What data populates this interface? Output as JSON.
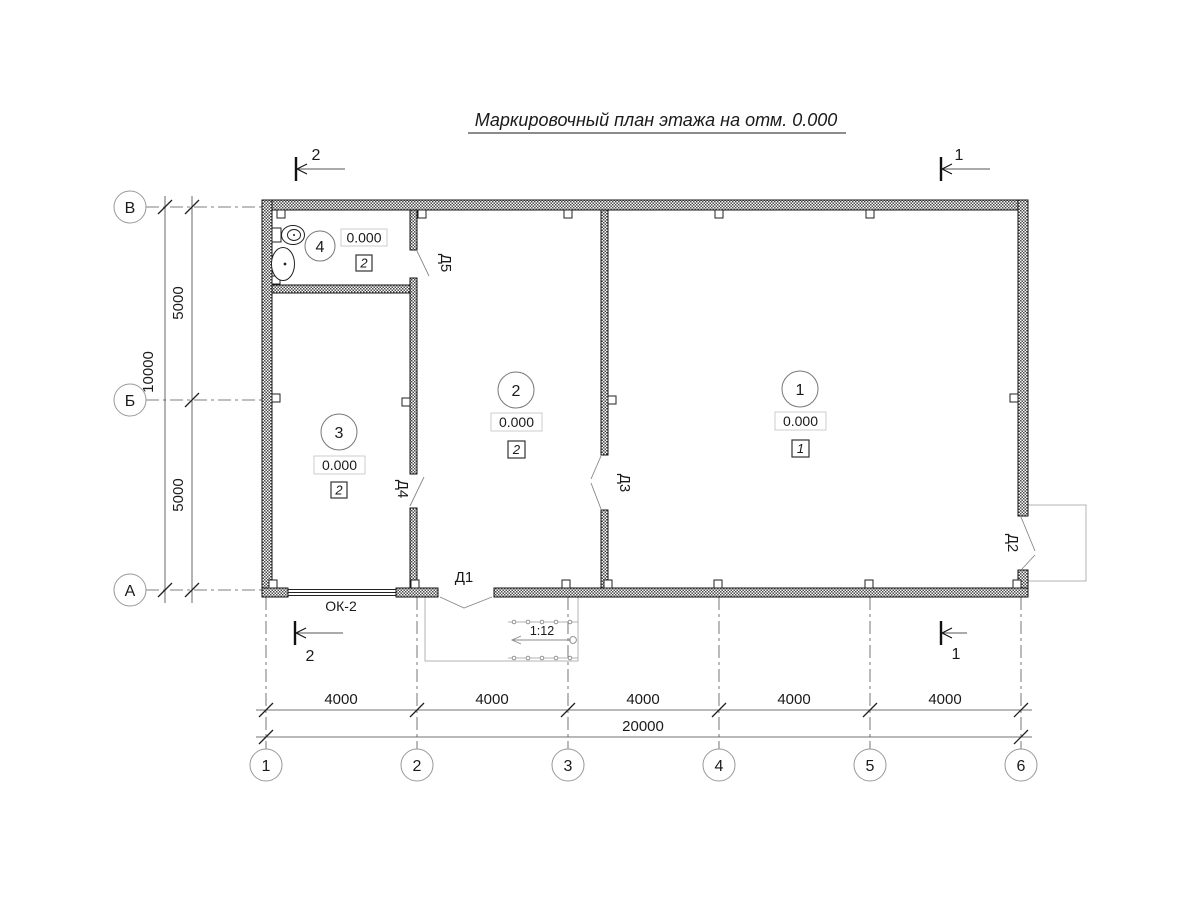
{
  "title": "Маркировочный план этажа на отм. 0.000",
  "colors": {
    "ink": "#1a1a1a",
    "secondary": "#808080",
    "light": "#b3b3b3"
  },
  "rooms": [
    {
      "number": "1",
      "elevation": "0.000",
      "type": "1"
    },
    {
      "number": "2",
      "elevation": "0.000",
      "type": "2"
    },
    {
      "number": "3",
      "elevation": "0.000",
      "type": "2"
    },
    {
      "number": "4",
      "elevation": "0.000",
      "type": "2"
    }
  ],
  "doors": {
    "d1": "Д1",
    "d2": "Д2",
    "d3": "Д3",
    "d4": "Д4",
    "d5": "Д5"
  },
  "window_label": "ОК-2",
  "ramp": {
    "slope": "1:12"
  },
  "axes": {
    "columns": [
      "1",
      "2",
      "3",
      "4",
      "5",
      "6"
    ],
    "rows": [
      "В",
      "Б",
      "А"
    ]
  },
  "dim_bottom": {
    "segments": [
      "4000",
      "4000",
      "4000",
      "4000",
      "4000"
    ],
    "total": "20000"
  },
  "dim_left": {
    "segments": [
      "5000",
      "5000"
    ],
    "total": "10000"
  },
  "sections": {
    "top_left": "2",
    "top_right": "1",
    "bottom_left": "2",
    "bottom_right": "1"
  }
}
